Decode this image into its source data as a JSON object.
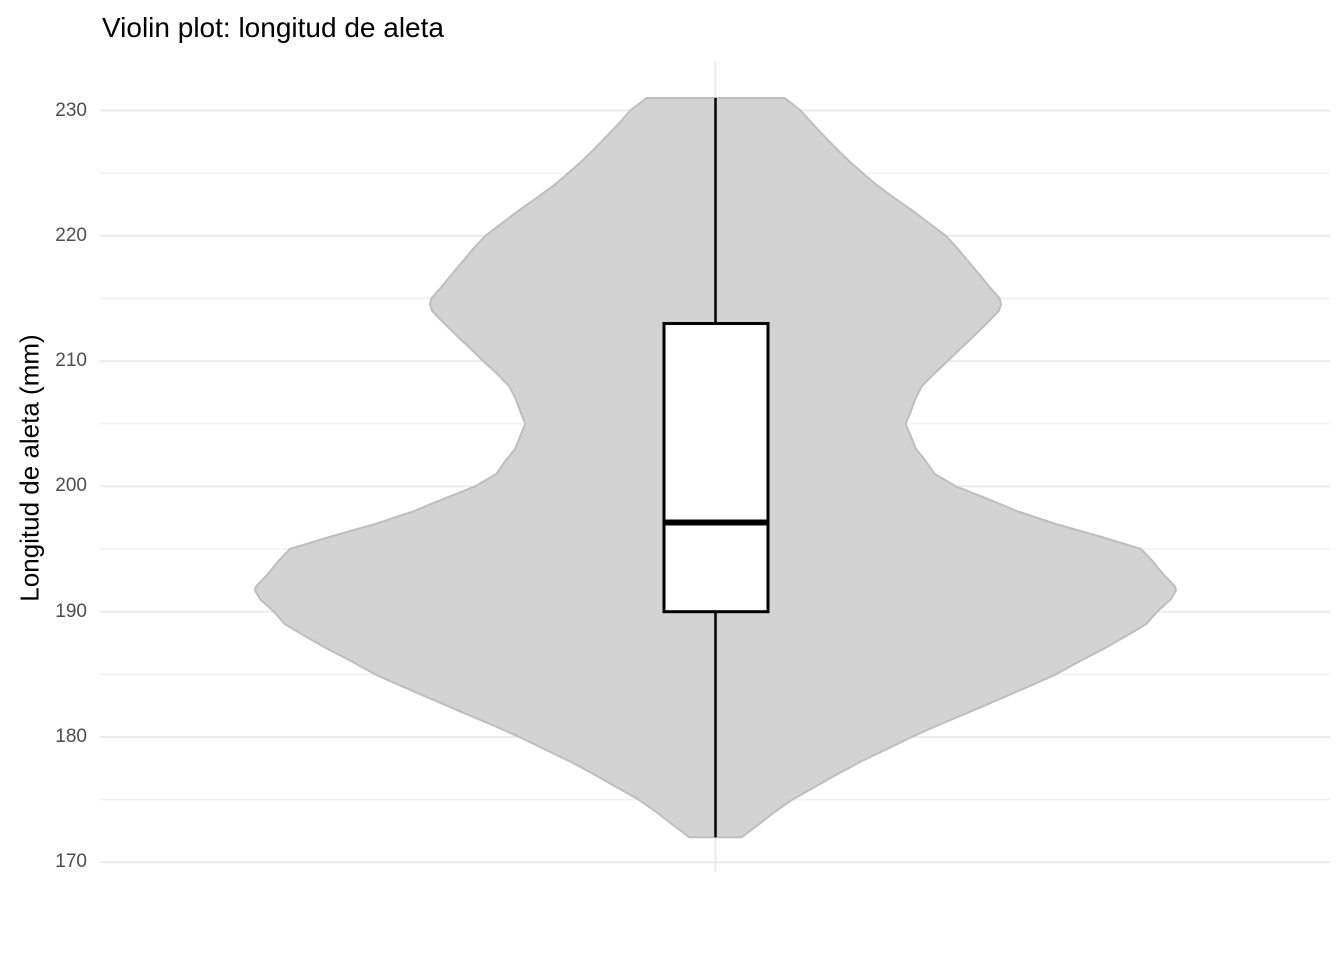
{
  "title": "Violin plot: longitud de aleta",
  "y_axis": {
    "label": "Longitud de aleta (mm)",
    "ticks": [
      230,
      220,
      210,
      200,
      190,
      180,
      170
    ],
    "minor_ticks": [
      225,
      215,
      205,
      195,
      185,
      175
    ],
    "range": [
      169,
      234
    ]
  },
  "x_axis": {
    "label": "",
    "categories": [
      ""
    ]
  },
  "chart_data": {
    "type": "violin",
    "title": "Violin plot: longitud de aleta",
    "ylabel": "Longitud de aleta (mm)",
    "ylim": [
      169,
      234
    ],
    "grid": "on",
    "legend": "none",
    "series": [
      {
        "name": "longitud de aleta",
        "boxplot_stats": {
          "min": 172,
          "q1": 190,
          "median": 197,
          "q3": 213,
          "max": 231
        },
        "violin_profile": [
          [
            231,
            0.15
          ],
          [
            230,
            0.185
          ],
          [
            229,
            0.209
          ],
          [
            228,
            0.235
          ],
          [
            227,
            0.261
          ],
          [
            226,
            0.289
          ],
          [
            225,
            0.32
          ],
          [
            224,
            0.352
          ],
          [
            223,
            0.389
          ],
          [
            222,
            0.428
          ],
          [
            221,
            0.464
          ],
          [
            220,
            0.5
          ],
          [
            219,
            0.525
          ],
          [
            218,
            0.548
          ],
          [
            217,
            0.571
          ],
          [
            216,
            0.593
          ],
          [
            215,
            0.617
          ],
          [
            214.5,
            0.62
          ],
          [
            214,
            0.615
          ],
          [
            213,
            0.589
          ],
          [
            212,
            0.561
          ],
          [
            211,
            0.532
          ],
          [
            210,
            0.504
          ],
          [
            209,
            0.475
          ],
          [
            208,
            0.448
          ],
          [
            207,
            0.434
          ],
          [
            206,
            0.424
          ],
          [
            205,
            0.413
          ],
          [
            204,
            0.424
          ],
          [
            203,
            0.435
          ],
          [
            202,
            0.457
          ],
          [
            201,
            0.476
          ],
          [
            200,
            0.522
          ],
          [
            199,
            0.591
          ],
          [
            198,
            0.657
          ],
          [
            197,
            0.739
          ],
          [
            196,
            0.835
          ],
          [
            195,
            0.924
          ],
          [
            194,
            0.95
          ],
          [
            193,
            0.972
          ],
          [
            192,
            0.998
          ],
          [
            191.7,
            1.0
          ],
          [
            191,
            0.989
          ],
          [
            190,
            0.959
          ],
          [
            189,
            0.935
          ],
          [
            188,
            0.889
          ],
          [
            187,
            0.841
          ],
          [
            186,
            0.789
          ],
          [
            185,
            0.739
          ],
          [
            184,
            0.678
          ],
          [
            183,
            0.615
          ],
          [
            182,
            0.552
          ],
          [
            181,
            0.487
          ],
          [
            180,
            0.426
          ],
          [
            179,
            0.37
          ],
          [
            178,
            0.313
          ],
          [
            177,
            0.263
          ],
          [
            176,
            0.215
          ],
          [
            175,
            0.167
          ],
          [
            174,
            0.128
          ],
          [
            173,
            0.093
          ],
          [
            172,
            0.057
          ]
        ]
      }
    ]
  },
  "colors": {
    "background": "#ffffff",
    "violin_fill": "#d3d3d3",
    "violin_outline": "#bebebe",
    "box_fill": "#ffffff",
    "box_outline": "#000000",
    "median_line": "#000000",
    "whisker": "#000000",
    "grid_major": "#ebebeb",
    "grid_minor": "#f0f0f0",
    "tick_text": "#4d4d4d",
    "title_text": "#000000"
  }
}
